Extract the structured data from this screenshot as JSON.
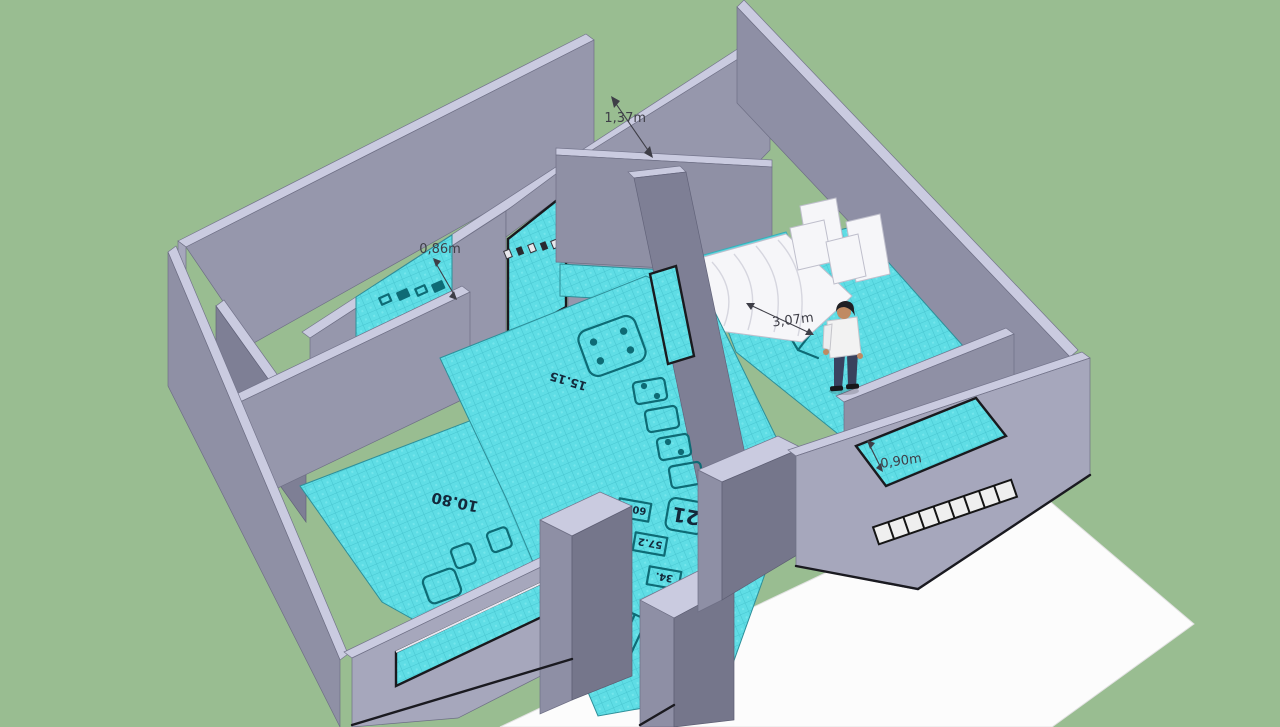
{
  "annotations": {
    "dimensions": [
      {
        "id": "corridor-width",
        "value": "1,37m"
      },
      {
        "id": "wall-opening-width",
        "value": "0,86m"
      },
      {
        "id": "bedroom-wall-length",
        "value": "3,07m"
      },
      {
        "id": "window-opening-width",
        "value": "0,90m"
      }
    ]
  },
  "floor_plan_texture": {
    "area_labels": [
      {
        "value": "15.15"
      },
      {
        "value": "10.80"
      },
      {
        "value": "21"
      },
      {
        "value": "60.1"
      },
      {
        "value": "57.2"
      },
      {
        "value": "34."
      }
    ]
  },
  "colors": {
    "background": "#99BD91",
    "ground_plane": "#FCFCFC",
    "wall_top": "#CACBE0",
    "wall_face_light": "#A6A7BC",
    "wall_face_medium": "#9697AC",
    "wall_face_dark": "#7E7F95",
    "floor": "#5FDDE5",
    "floor_plan_ink": "#0E6B75",
    "dimension_text": "#3E3E47",
    "person_shirt": "#F2F2F2",
    "person_pants": "#3A4260",
    "person_skin": "#C08A62"
  }
}
